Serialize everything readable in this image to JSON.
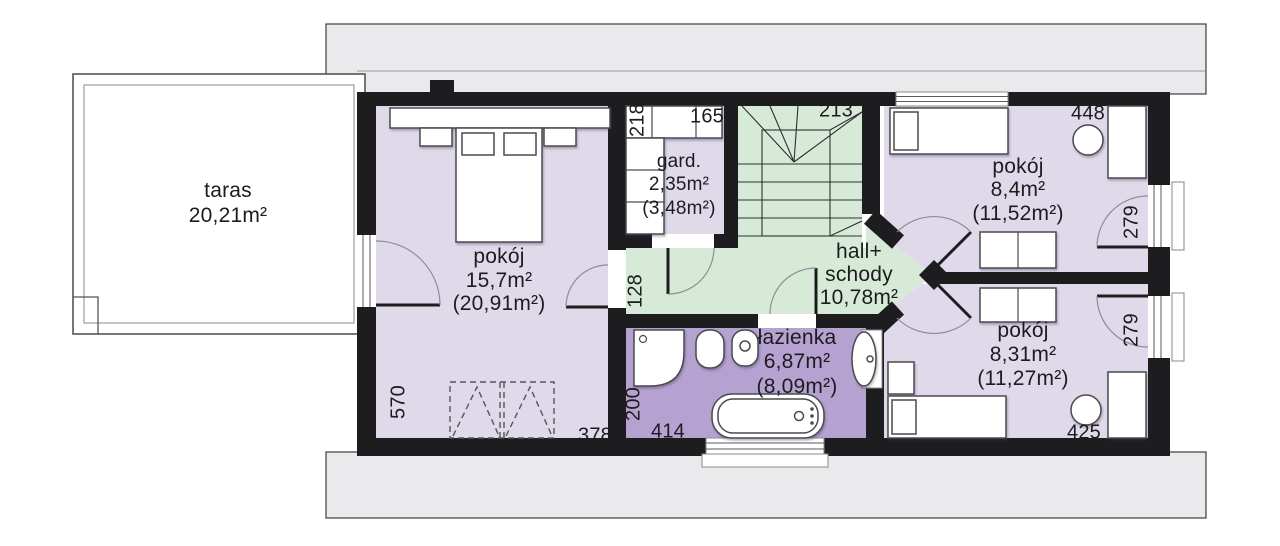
{
  "rooms": {
    "taras": {
      "name": "taras",
      "area": "20,21m²"
    },
    "bedroom": {
      "name": "pokój",
      "area": "15,7m²",
      "area_gross": "(20,91m²)"
    },
    "wardrobe": {
      "name": "gard.",
      "area": "2,35m²",
      "area_gross": "(3,48m²)"
    },
    "hall": {
      "name_line1": "hall+",
      "name_line2": "schody",
      "area": "10,78m²"
    },
    "bathroom": {
      "name": "łazienka",
      "area": "6,87m²",
      "area_gross": "(8,09m²)"
    },
    "room_top_right": {
      "name": "pokój",
      "area": "8,4m²",
      "area_gross": "(11,52m²)"
    },
    "room_bottom_right": {
      "name": "pokój",
      "area": "8,31m²",
      "area_gross": "(11,27m²)"
    }
  },
  "dimensions": {
    "wardrobe_depth": "218",
    "wardrobe_width": "165",
    "stairs_width": "213",
    "room_top_width": "448",
    "balcony_top": "279",
    "balcony_bottom": "279",
    "room_bottom_width": "425",
    "hall_width": "128",
    "bathroom_depth": "200",
    "bathroom_width": "414",
    "bedroom_depth": "570",
    "bedroom_width": "378"
  },
  "colors": {
    "room": "#e0d9ea",
    "hall": "#d7ead8",
    "bath": "#b5a2d1",
    "roof": "#eaeaec",
    "wall": "#1d1d20"
  }
}
